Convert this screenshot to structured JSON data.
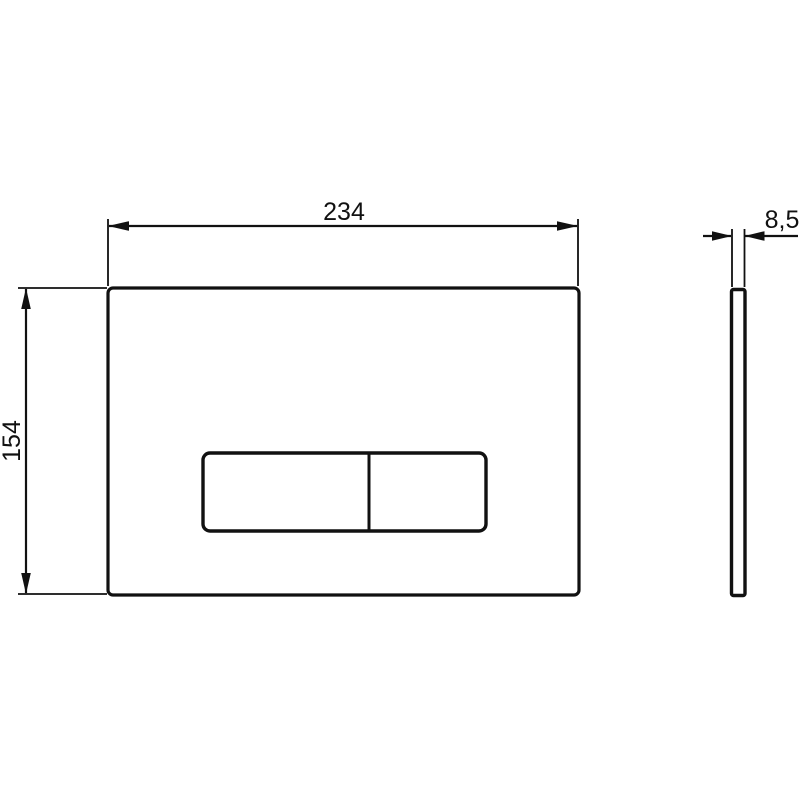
{
  "drawing": {
    "background_color": "#ffffff",
    "line_color": "#111111",
    "labels": {
      "width": "234",
      "height": "154",
      "thickness": "8,5"
    }
  }
}
